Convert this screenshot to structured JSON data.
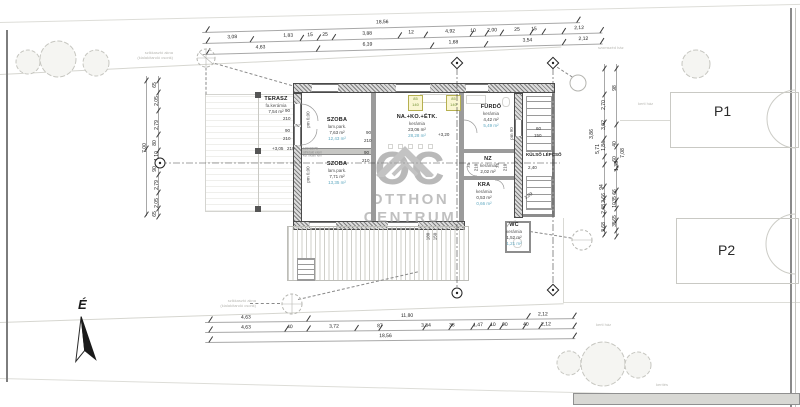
{
  "watermark": {
    "logo_text": "OC",
    "line1": "OTTHON",
    "line2": "CENTRUM"
  },
  "north_label": "É",
  "parking": {
    "p1": "P1",
    "p2": "P2"
  },
  "rooms": {
    "terasz": {
      "name": "TERASZ",
      "finish": "fa.kerámia",
      "area": "7,54 m²"
    },
    "szoba1": {
      "name": "SZOBA",
      "finish": "lam.park.",
      "area": "7,63 m²",
      "area2": "12,43 m²"
    },
    "nappali": {
      "name": "NA.+KO.+ÉTK.",
      "finish": "kerámia",
      "area": "23,06 m²",
      "area2": "28,28 m²"
    },
    "szoba2": {
      "name": "SZOBA",
      "finish": "lam.park.",
      "area": "7,71 m²",
      "area2": "13,35 m²"
    },
    "furdo": {
      "name": "FÜRDŐ",
      "finish": "kerámia",
      "area": "4,42 m²",
      "area2": "5,49 m²"
    },
    "nz": {
      "name": "NZ",
      "finish": "kerámia",
      "area": "2,02 m²"
    },
    "kamra": {
      "name": "KRA",
      "finish": "kerámia",
      "area": "0,53 m²",
      "area2": "0,66 m²"
    },
    "wc": {
      "name": "WC",
      "finish": "kerámia",
      "area": "1,52 m²",
      "area2": "1,21 m²"
    }
  },
  "labels": {
    "kulso_lepcso": "KÜLSŐ LÉPCSŐ",
    "lvl_terasz": "+3,05",
    "lvl_main": "+3,20",
    "pm0": "pm 0,00",
    "pm90": "pm 90",
    "shaft_note1": "szikkasztó akna",
    "shaft_note2": "(kialakítandó csonk)",
    "neighbor_top": "szomszéd ház",
    "neighbor_p1": "kerti ház",
    "neighbor_p2": "kerti ház",
    "fence": "kerítés",
    "lintel1": "100*150*5",
    "lintel2": "áthidaló elem",
    "lintel3": "két oldalt fém"
  },
  "dims": {
    "top_overall": "18,56",
    "top_row1": [
      "3,08",
      "1,83",
      "15",
      "25",
      "3,88",
      "12",
      "4,92",
      "10",
      "2,00",
      "25",
      "15",
      "2,12"
    ],
    "top_row2": [
      "4,63",
      "6,39",
      "1,68",
      "3,54",
      "2,12"
    ],
    "bottom_row1": [
      "4,63",
      "11,80",
      "2,12"
    ],
    "bottom_row2": [
      "4,63",
      "40",
      "3,72",
      "87",
      "3,34",
      "38",
      "1,47",
      "10",
      "90",
      "40",
      "2,12"
    ],
    "bottom_overall": "18,56",
    "left_col": [
      "65",
      "2,05",
      "2,79",
      "80",
      "1,10",
      "90",
      "2,79",
      "2,05",
      "65"
    ],
    "left_overall": "7,00",
    "right_col": [
      "98",
      "2,70",
      "3,02",
      "3,86",
      "5,71",
      "1,84",
      "40",
      "7,08",
      "60",
      "1,35",
      "94",
      "66",
      "2,66",
      "35",
      "10",
      "2,48",
      "65",
      "35",
      "2,68"
    ],
    "openings": {
      "w90": "90",
      "h210": "210",
      "w75": "75",
      "win60": "60",
      "win150": "150",
      "y85": "85",
      "y140": "140",
      "v180": "180",
      "v150": "150",
      "stair_w": "2,40",
      "diag": "1,09"
    }
  }
}
